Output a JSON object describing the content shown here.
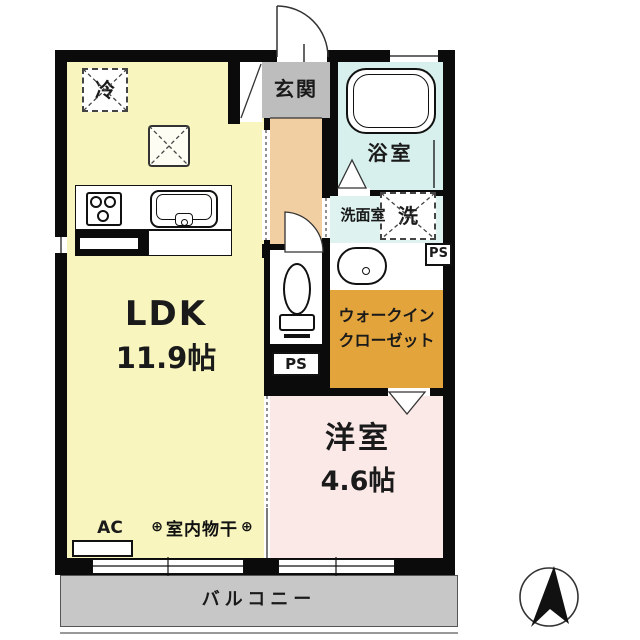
{
  "floor_plan": {
    "rooms": {
      "ldk": {
        "name": "LDK",
        "size": "11.9帖"
      },
      "western_room": {
        "name": "洋室",
        "size": "4.6帖"
      },
      "entrance": {
        "name": "玄関"
      },
      "bathroom": {
        "name": "浴室"
      },
      "washroom": {
        "name": "洗面室"
      },
      "walk_in_closet": {
        "line1": "ウォークイン",
        "line2": "クローゼット"
      },
      "balcony": {
        "name": "バルコニー"
      }
    },
    "fixtures": {
      "refrigerator": "冷",
      "washing_machine": "洗",
      "air_conditioner": "AC",
      "indoor_laundry_pole": "室内物干",
      "hook_symbol": "⊕",
      "pipe_space_upper": "PS",
      "pipe_space_lower": "PS"
    },
    "colors": {
      "ldk": "#f8f5bf",
      "western_room": "#fbe9e8",
      "hallway": "#f2cfa2",
      "entrance": "#bdbdbd",
      "bathroom": "#d8f0ed",
      "washroom": "#def3f0",
      "walk_in_closet": "#e3a43c",
      "balcony": "#c7c7c7",
      "wall": "#0b0b0b"
    }
  }
}
